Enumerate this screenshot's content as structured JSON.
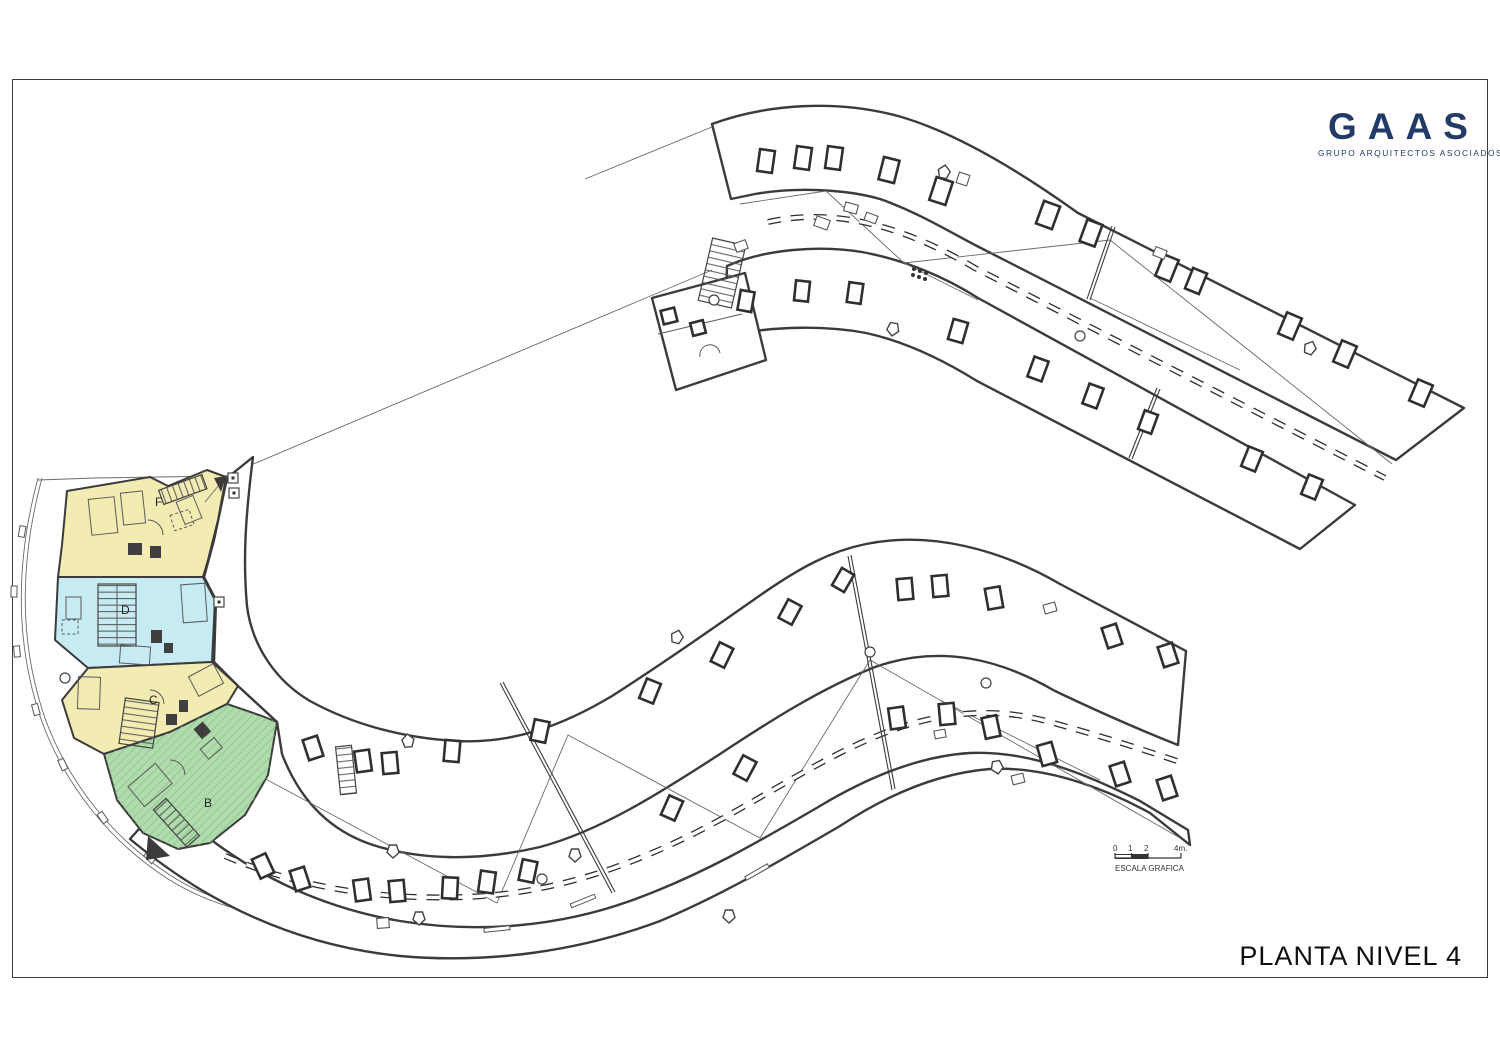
{
  "document": {
    "title": "PLANTA NIVEL 4"
  },
  "logo": {
    "name": "GAAS",
    "subtitle": "GRUPO ARQUITECTOS ASOCIADOS",
    "color": "#223a68"
  },
  "scale_bar": {
    "label": "ESCALA GRAFICA",
    "ticks": [
      "0",
      "1",
      "2",
      "4m."
    ]
  },
  "units": [
    {
      "id": "unit-f",
      "label": "F",
      "color": "#F2ECB3"
    },
    {
      "id": "unit-d",
      "label": "D",
      "color": "#C6EBF3"
    },
    {
      "id": "unit-c",
      "label": "C",
      "color": "#F2ECB3"
    },
    {
      "id": "unit-b",
      "label": "B",
      "color": "#AFDBAD"
    }
  ],
  "drawing": {
    "ink": "#3b3b3b",
    "thin_ink": "#6a6a6a",
    "skylights_bold": [
      [
        766,
        161,
        15,
        22,
        8
      ],
      [
        803,
        158,
        15,
        22,
        8
      ],
      [
        834,
        158,
        15,
        22,
        8
      ],
      [
        889,
        170,
        16,
        23,
        14
      ],
      [
        941,
        191,
        17,
        24,
        18
      ],
      [
        1048,
        215,
        17,
        24,
        20
      ],
      [
        1091,
        233,
        16,
        23,
        20
      ],
      [
        1167,
        268,
        16,
        23,
        22
      ],
      [
        1196,
        281,
        15,
        22,
        22
      ],
      [
        1290,
        326,
        16,
        23,
        23
      ],
      [
        1345,
        354,
        16,
        23,
        23
      ],
      [
        1421,
        393,
        16,
        23,
        23
      ],
      [
        746,
        301,
        14,
        20,
        10
      ],
      [
        802,
        291,
        14,
        20,
        6
      ],
      [
        855,
        293,
        14,
        20,
        8
      ],
      [
        958,
        331,
        15,
        21,
        16
      ],
      [
        1038,
        369,
        15,
        21,
        20
      ],
      [
        1093,
        396,
        15,
        21,
        20
      ],
      [
        1148,
        422,
        14,
        20,
        20
      ],
      [
        1252,
        459,
        15,
        21,
        22
      ],
      [
        1312,
        487,
        15,
        21,
        22
      ],
      [
        669,
        316,
        14,
        14,
        -14
      ],
      [
        698,
        328,
        13,
        13,
        -14
      ],
      [
        313,
        748,
        15,
        21,
        -18
      ],
      [
        363,
        761,
        15,
        21,
        -8
      ],
      [
        390,
        763,
        15,
        21,
        -5
      ],
      [
        452,
        751,
        15,
        21,
        5
      ],
      [
        540,
        731,
        15,
        21,
        12
      ],
      [
        650,
        691,
        15,
        21,
        22
      ],
      [
        722,
        655,
        15,
        21,
        26
      ],
      [
        790,
        612,
        15,
        21,
        28
      ],
      [
        843,
        580,
        14,
        20,
        30
      ],
      [
        905,
        589,
        15,
        21,
        -5
      ],
      [
        940,
        586,
        15,
        21,
        -5
      ],
      [
        994,
        598,
        15,
        21,
        -10
      ],
      [
        1112,
        636,
        15,
        21,
        -18
      ],
      [
        1168,
        655,
        15,
        21,
        -18
      ],
      [
        263,
        866,
        15,
        21,
        -25
      ],
      [
        300,
        879,
        15,
        21,
        -18
      ],
      [
        362,
        890,
        15,
        21,
        -8
      ],
      [
        397,
        891,
        15,
        21,
        -5
      ],
      [
        450,
        888,
        15,
        21,
        3
      ],
      [
        487,
        882,
        15,
        21,
        8
      ],
      [
        528,
        871,
        15,
        21,
        12
      ],
      [
        672,
        808,
        15,
        21,
        24
      ],
      [
        745,
        768,
        15,
        21,
        28
      ],
      [
        897,
        718,
        15,
        21,
        -8
      ],
      [
        947,
        714,
        15,
        21,
        -5
      ],
      [
        991,
        727,
        15,
        21,
        -12
      ],
      [
        1047,
        754,
        15,
        21,
        -16
      ],
      [
        1120,
        774,
        15,
        21,
        -18
      ],
      [
        1167,
        788,
        15,
        21,
        -18
      ]
    ],
    "skylights_thin": [
      [
        851,
        208,
        13,
        9,
        15
      ],
      [
        822,
        223,
        14,
        10,
        20
      ],
      [
        871,
        218,
        12,
        8,
        20
      ],
      [
        1160,
        253,
        12,
        9,
        22
      ],
      [
        383,
        923,
        12,
        10,
        -5
      ],
      [
        1018,
        779,
        12,
        9,
        -14
      ],
      [
        940,
        734,
        11,
        8,
        -10
      ],
      [
        1050,
        608,
        12,
        9,
        -15
      ],
      [
        741,
        246,
        12,
        9,
        -20
      ],
      [
        963,
        179,
        11,
        11,
        18
      ]
    ],
    "vents_pentagon": [
      [
        944,
        172,
        10
      ],
      [
        408,
        741,
        -5
      ],
      [
        677,
        637,
        15
      ],
      [
        575,
        855,
        180
      ],
      [
        419,
        918,
        180
      ],
      [
        729,
        916,
        180
      ],
      [
        997,
        767,
        170
      ],
      [
        1310,
        348,
        22
      ],
      [
        893,
        329,
        190
      ],
      [
        393,
        851,
        180
      ]
    ],
    "drain_circles": [
      [
        65,
        678,
        5
      ],
      [
        542,
        879,
        5
      ],
      [
        870,
        652,
        5
      ],
      [
        986,
        683,
        5
      ],
      [
        1080,
        336,
        5
      ],
      [
        714,
        300,
        5
      ]
    ],
    "wall_markers": [
      [
        233,
        478
      ],
      [
        234,
        493
      ],
      [
        219,
        602
      ]
    ]
  }
}
